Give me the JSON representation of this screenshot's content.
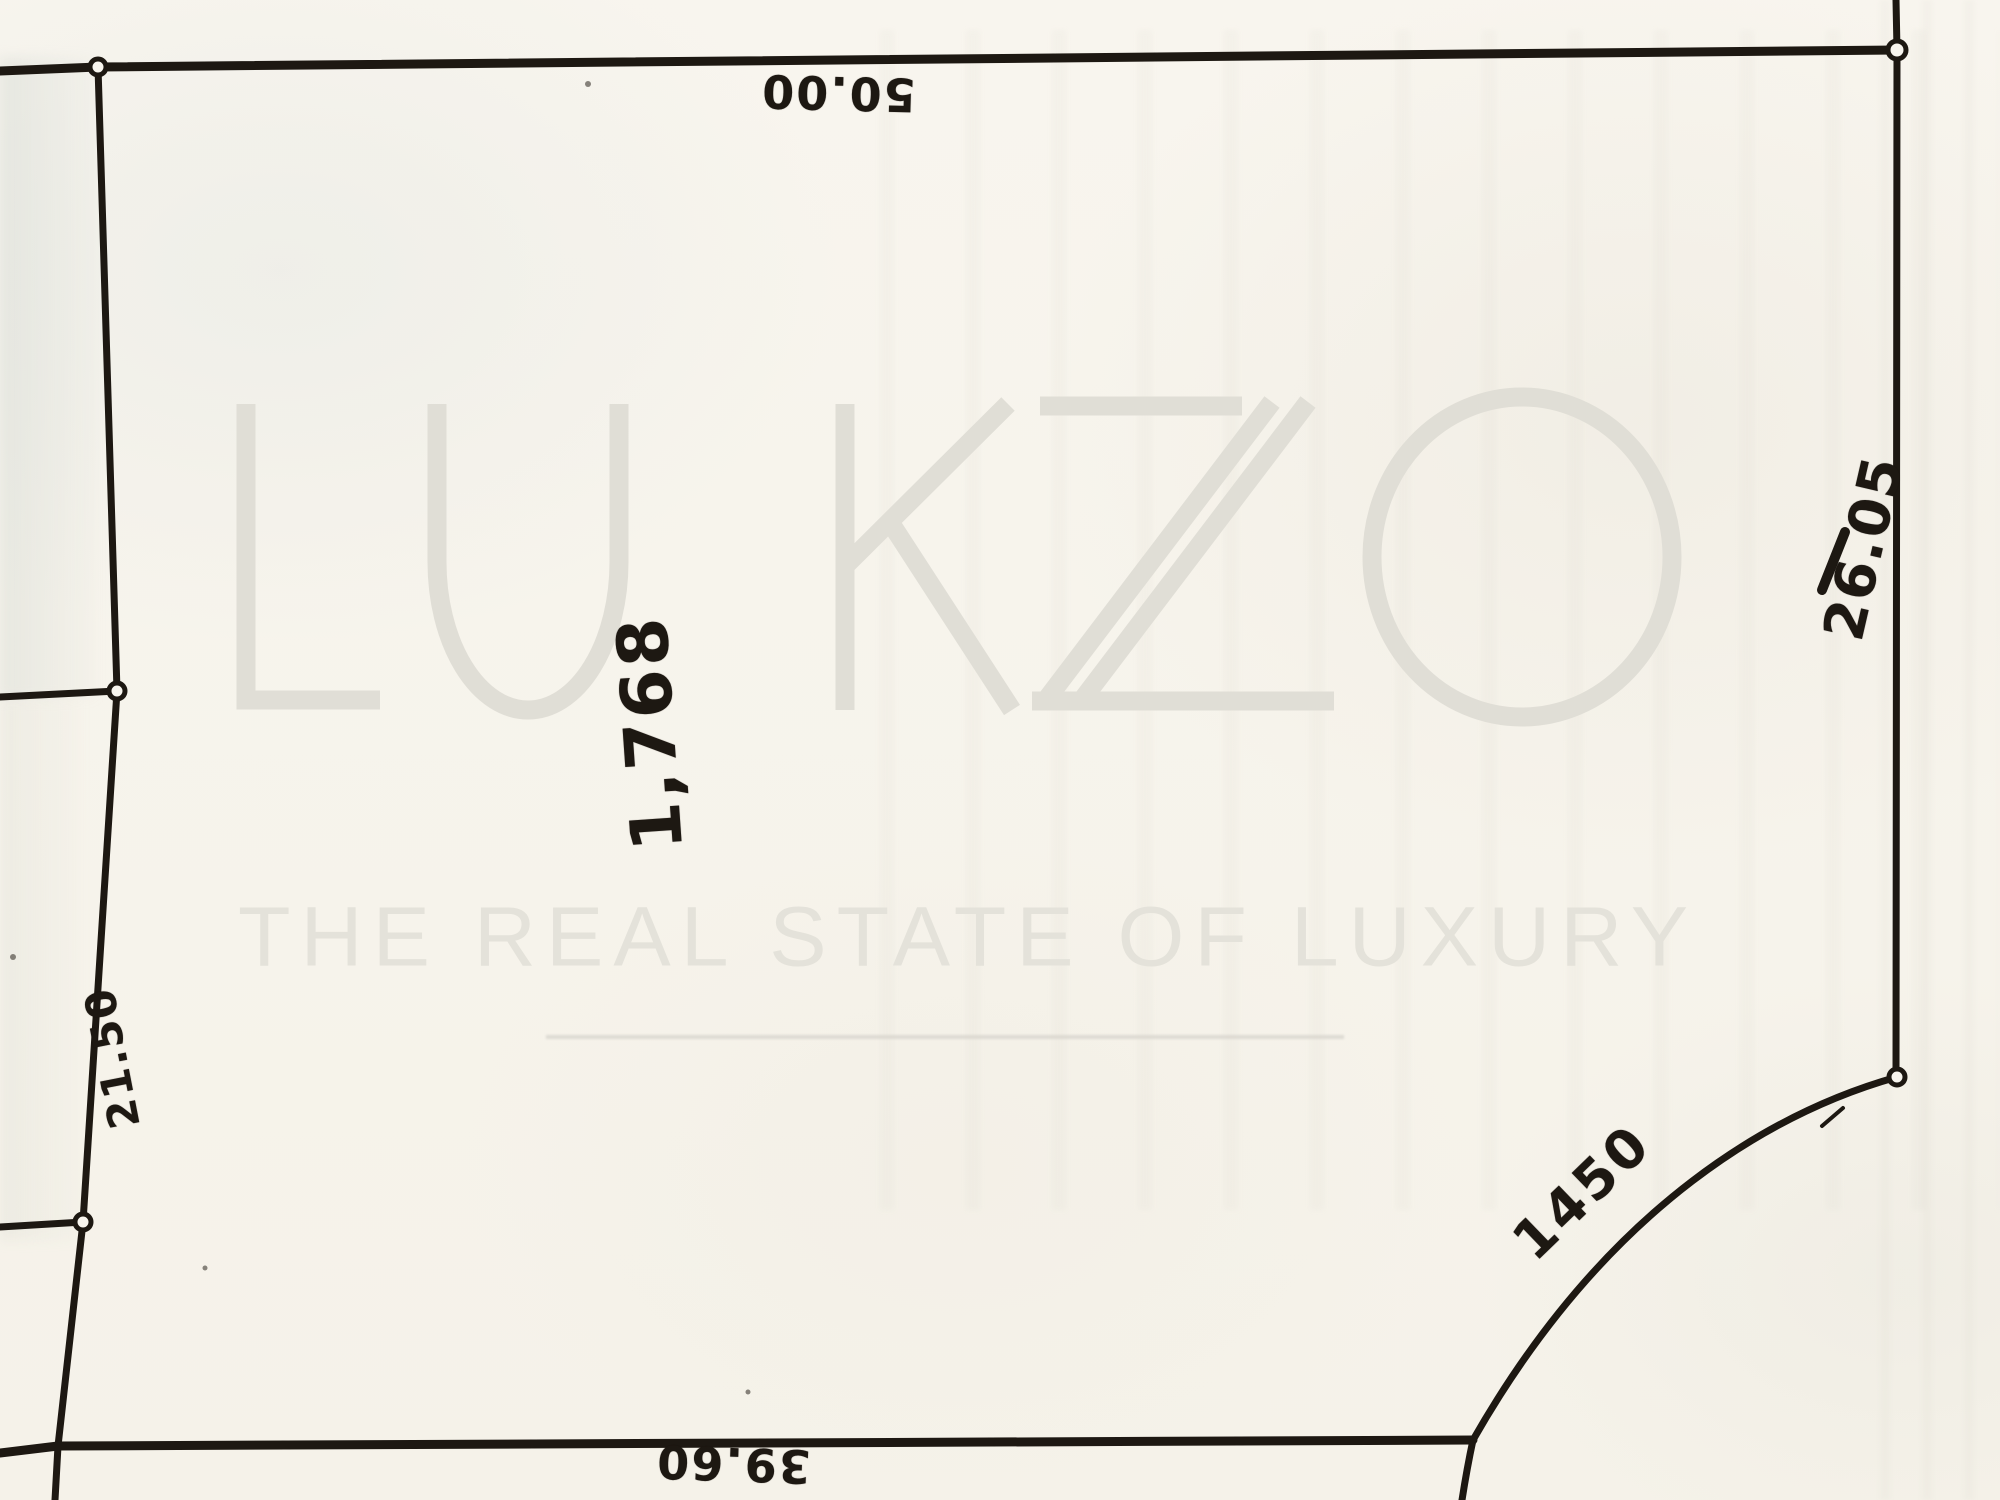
{
  "watermark": {
    "brand": "LUKZO",
    "tagline": "THE REAL STATE OF LUXURY",
    "brand_color": "#e0ded6",
    "tagline_color": "#e4e2da"
  },
  "survey": {
    "area_label": "1,768",
    "dimension_labels": {
      "top": "50.00",
      "right": "26.05",
      "left": "21.50",
      "bottom": "39.60",
      "curve": "1450"
    },
    "ink_color": "#1d1812",
    "paper_color": "#f7f4ed"
  }
}
